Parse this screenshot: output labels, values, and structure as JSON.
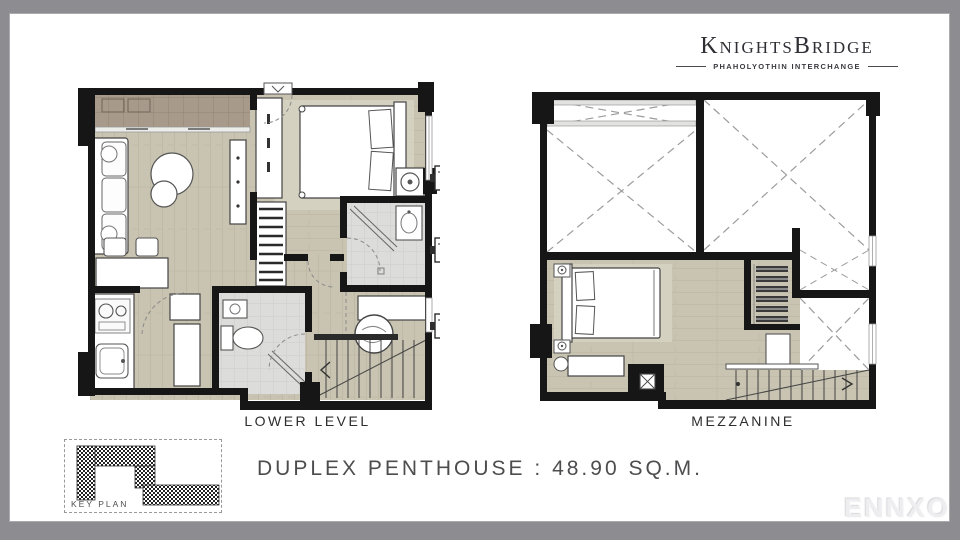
{
  "window": {
    "frame_color": "#8c8c91",
    "canvas_color": "#ffffff"
  },
  "logo": {
    "brand": "KnightsBridge",
    "subtitle": "PHAHOLYOTHIN INTERCHANGE"
  },
  "plans": [
    {
      "id": "lower-level",
      "label": "LOWER LEVEL"
    },
    {
      "id": "mezzanine",
      "label": "MEZZANINE"
    }
  ],
  "caption": "DUPLEX PENTHOUSE : 48.90 SQ.M.",
  "key_plan_label": "KEY PLAN",
  "watermark": "ENNXO",
  "colors": {
    "wall": "#161616",
    "wood_floor": "#c8c4b1",
    "rug": "#d8d4c4",
    "balcony_tile": "#a79a8b",
    "bath_tile": "#dcdcda",
    "void_dash": "#9c9c9c",
    "logo_text": "#2e2e35",
    "caption_text": "#4d4d4f"
  }
}
